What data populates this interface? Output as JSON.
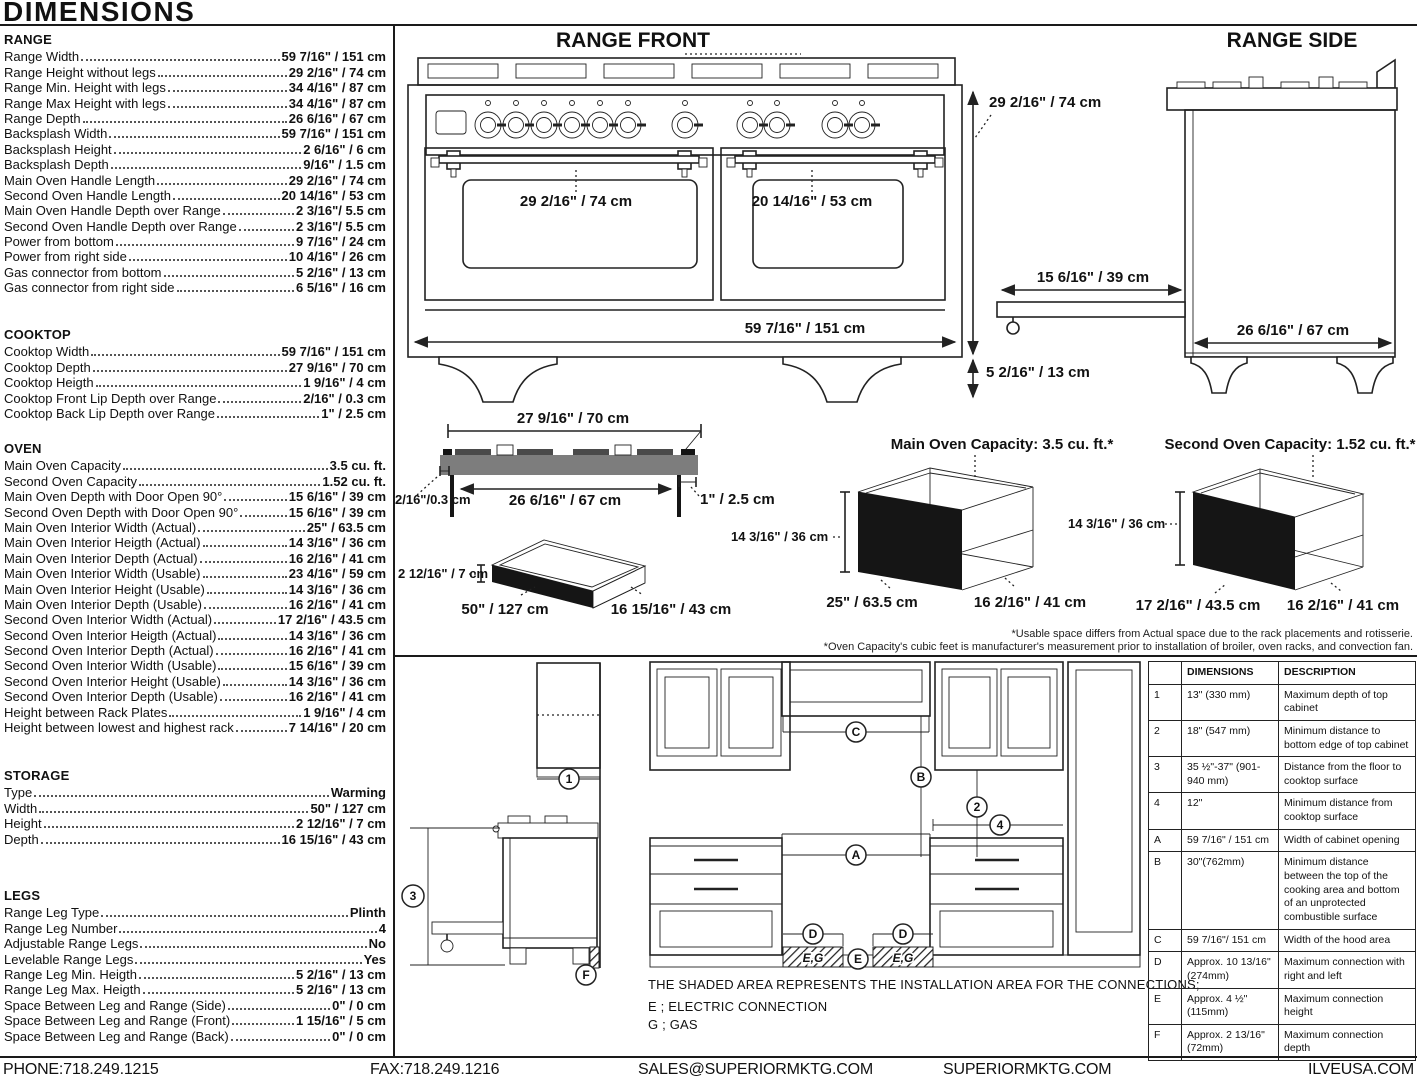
{
  "page_title": "DIMENSIONS",
  "specs": {
    "range": {
      "heading": "RANGE",
      "items": [
        {
          "label": "Range Width",
          "value": "59 7/16\" / 151 cm"
        },
        {
          "label": "Range Height without legs",
          "value": "29 2/16\" / 74 cm"
        },
        {
          "label": "Range Min. Height with legs",
          "value": "34 4/16\" / 87 cm"
        },
        {
          "label": "Range Max Height with legs",
          "value": "34 4/16\" / 87 cm"
        },
        {
          "label": "Range Depth",
          "value": "26 6/16\" / 67 cm"
        },
        {
          "label": "Backsplash Width",
          "value": "59 7/16\" / 151 cm"
        },
        {
          "label": "Backsplash Height",
          "value": "2 6/16\" / 6 cm"
        },
        {
          "label": "Backsplash Depth",
          "value": "9/16\" / 1.5 cm"
        },
        {
          "label": "Main Oven Handle Length",
          "value": "29 2/16\" / 74 cm"
        },
        {
          "label": "Second Oven Handle Length",
          "value": "20 14/16\" / 53 cm"
        },
        {
          "label": "Main Oven Handle Depth over Range",
          "value": "2 3/16\"/ 5.5 cm"
        },
        {
          "label": "Second Oven Handle Depth over Range",
          "value": "2 3/16\"/ 5.5 cm"
        },
        {
          "label": "Power from bottom",
          "value": "9 7/16\" / 24 cm"
        },
        {
          "label": "Power from right side",
          "value": "10 4/16\" / 26 cm"
        },
        {
          "label": "Gas connector from bottom",
          "value": "5 2/16\" / 13 cm"
        },
        {
          "label": "Gas connector from right side",
          "value": "6 5/16\" / 16 cm"
        }
      ]
    },
    "cooktop": {
      "heading": "COOKTOP",
      "items": [
        {
          "label": "Cooktop Width",
          "value": "59 7/16\" / 151 cm"
        },
        {
          "label": "Cooktop Depth",
          "value": "27 9/16\" / 70 cm"
        },
        {
          "label": "Cooktop Heigth",
          "value": "1 9/16\" / 4 cm"
        },
        {
          "label": "Cooktop Front Lip Depth over Range",
          "value": "2/16\" / 0.3 cm"
        },
        {
          "label": "Cooktop Back Lip Depth over Range",
          "value": "1\" / 2.5 cm"
        }
      ]
    },
    "oven": {
      "heading": "OVEN",
      "items": [
        {
          "label": "Main Oven Capacity",
          "value": "3.5 cu. ft."
        },
        {
          "label": "Second Oven Capacity",
          "value": "1.52 cu. ft."
        },
        {
          "label": "Main Oven Depth with Door Open 90°",
          "value": "15 6/16\" / 39 cm"
        },
        {
          "label": "Second Oven Depth with Door Open 90°",
          "value": "15 6/16\" / 39 cm"
        },
        {
          "label": "Main Oven Interior Width (Actual)",
          "value": "25\" / 63.5 cm"
        },
        {
          "label": "Main Oven Interior Heigth (Actual)",
          "value": "14 3/16\" / 36 cm"
        },
        {
          "label": "Main Oven Interior Depth (Actual)",
          "value": "16 2/16\" / 41 cm"
        },
        {
          "label": "Main Oven Interior Width (Usable)",
          "value": "23 4/16\" / 59 cm"
        },
        {
          "label": "Main Oven Interior Height (Usable)",
          "value": "14 3/16\" / 36 cm"
        },
        {
          "label": "Main Oven Interior Depth (Usable)",
          "value": "16 2/16\" / 41 cm"
        },
        {
          "label": "Second Oven Interior Width (Actual)",
          "value": "17 2/16\" / 43.5 cm"
        },
        {
          "label": "Second Oven Interior Heigth (Actual)",
          "value": "14 3/16\" / 36 cm"
        },
        {
          "label": "Second Oven Interior Depth (Actual)",
          "value": "16 2/16\" / 41 cm"
        },
        {
          "label": "Second Oven Interior Width (Usable)",
          "value": "15 6/16\" / 39 cm"
        },
        {
          "label": "Second Oven Interior Height (Usable)",
          "value": "14 3/16\" / 36 cm"
        },
        {
          "label": "Second Oven Interior Depth (Usable)",
          "value": "16 2/16\" / 41 cm"
        },
        {
          "label": "Height between Rack Plates",
          "value": "1 9/16\" / 4 cm"
        },
        {
          "label": "Height between lowest and highest rack",
          "value": "7 14/16\" / 20 cm"
        }
      ]
    },
    "storage": {
      "heading": "STORAGE",
      "items": [
        {
          "label": "Type",
          "value": "Warming"
        },
        {
          "label": "Width",
          "value": "50\" / 127 cm"
        },
        {
          "label": "Height",
          "value": "2 12/16\" / 7 cm"
        },
        {
          "label": "Depth",
          "value": "16 15/16\" / 43 cm"
        }
      ]
    },
    "legs": {
      "heading": "LEGS",
      "items": [
        {
          "label": "Range Leg Type",
          "value": "Plinth"
        },
        {
          "label": "Range Leg Number",
          "value": "4"
        },
        {
          "label": "Adjustable Range Legs",
          "value": "No"
        },
        {
          "label": "Levelable Range Legs",
          "value": "Yes"
        },
        {
          "label": "Range Leg Min. Heigth",
          "value": "5 2/16\" / 13 cm"
        },
        {
          "label": "Range Leg Max. Heigth",
          "value": "5 2/16\" / 13 cm"
        },
        {
          "label": "Space Between Leg and Range (Side)",
          "value": "0\" / 0 cm"
        },
        {
          "label": "Space Between Leg and Range (Front)",
          "value": "1 15/16\" / 5 cm"
        },
        {
          "label": "Space Between Leg and Range (Back)",
          "value": "0\" / 0 cm"
        }
      ]
    }
  },
  "diagrams": {
    "front": {
      "title": "RANGE FRONT",
      "main_oven_handle": "29 2/16\" / 74 cm",
      "second_oven_handle": "20 14/16\" / 53 cm",
      "range_width": "59 7/16\" / 151 cm",
      "range_height": "29 2/16\" / 74 cm",
      "leg_height": "5 2/16\" / 13 cm"
    },
    "side": {
      "title": "RANGE SIDE",
      "door_open": "15 6/16\" / 39 cm",
      "range_depth": "26 6/16\" / 67 cm"
    },
    "cooktop_profile": {
      "width_top": "27 9/16\" / 70 cm",
      "width_bottom": "26 6/16\" / 67 cm",
      "back_lip": "1\" / 2.5 cm",
      "front_lip": "2/16\"/0.3 cm"
    },
    "storage_box": {
      "height": "2 12/16\" / 7 cm",
      "width": "50\" / 127 cm",
      "depth": "16 15/16\" / 43 cm"
    },
    "main_oven_box": {
      "title": "Main Oven Capacity: 3.5 cu. ft.*",
      "height": "14 3/16\" / 36 cm",
      "width": "25\" / 63.5 cm",
      "depth": "16 2/16\" / 41 cm"
    },
    "second_oven_box": {
      "title": "Second Oven Capacity: 1.52 cu. ft.*",
      "height": "14 3/16\" / 36 cm",
      "width": "17 2/16\" / 43.5 cm",
      "depth": "16 2/16\" / 41 cm"
    },
    "footnotes": [
      "*Usable space differs from Actual space due to the rack placements and rotisserie.",
      "*Oven Capacity's cubic feet is manufacturer's measurement prior to installation of broiler, oven racks, and convection fan."
    ]
  },
  "installation": {
    "note": "THE SHADED AREA REPRESENTS THE INSTALLATION AREA FOR THE CONNECTIONS;",
    "electric_legend": "E ; ELECTRIC CONNECTION",
    "gas_legend": "G ; GAS",
    "callouts": {
      "n1": "1",
      "n2": "2",
      "n3": "3",
      "n4": "4",
      "a": "A",
      "b": "B",
      "c": "C",
      "d": "D",
      "e": "E",
      "f": "F",
      "eg": "E,G"
    },
    "table": {
      "headers": [
        "",
        "DIMENSIONS",
        "DESCRIPTION"
      ],
      "rows": [
        {
          "id": "1",
          "dim": "13\" (330 mm)",
          "desc": "Maximum depth of top cabinet"
        },
        {
          "id": "2",
          "dim": "18\" (547 mm)",
          "desc": "Minimum distance to bottom edge of top cabinet"
        },
        {
          "id": "3",
          "dim": "35 ½\"-37\" (901-940 mm)",
          "desc": "Distance from the floor to cooktop surface"
        },
        {
          "id": "4",
          "dim": "12\"",
          "desc": "Minimum distance from cooktop surface"
        },
        {
          "id": "A",
          "dim": "59 7/16\" / 151 cm",
          "desc": "Width of cabinet opening"
        },
        {
          "id": "B",
          "dim": "30\"(762mm)",
          "desc": "Minimum distance between the top of the cooking area and bottom of an unprotected combustible surface"
        },
        {
          "id": "C",
          "dim": "59 7/16\"/ 151 cm",
          "desc": "Width of the hood area"
        },
        {
          "id": "D",
          "dim": "Approx. 10 13/16\" (274mm)",
          "desc": "Maximum connection with right and left"
        },
        {
          "id": "E",
          "dim": "Approx. 4 ½\" (115mm)",
          "desc": "Maximum connection height"
        },
        {
          "id": "F",
          "dim": "Approx. 2 13/16\" (72mm)",
          "desc": "Maximum connection depth"
        }
      ]
    }
  },
  "footer": {
    "phone": "PHONE:718.249.1215",
    "fax": "FAX:718.249.1216",
    "email": "SALES@SUPERIORMKTG.COM",
    "website": "SUPERIORMKTG.COM",
    "brand_site": "ILVEUSA.COM"
  }
}
